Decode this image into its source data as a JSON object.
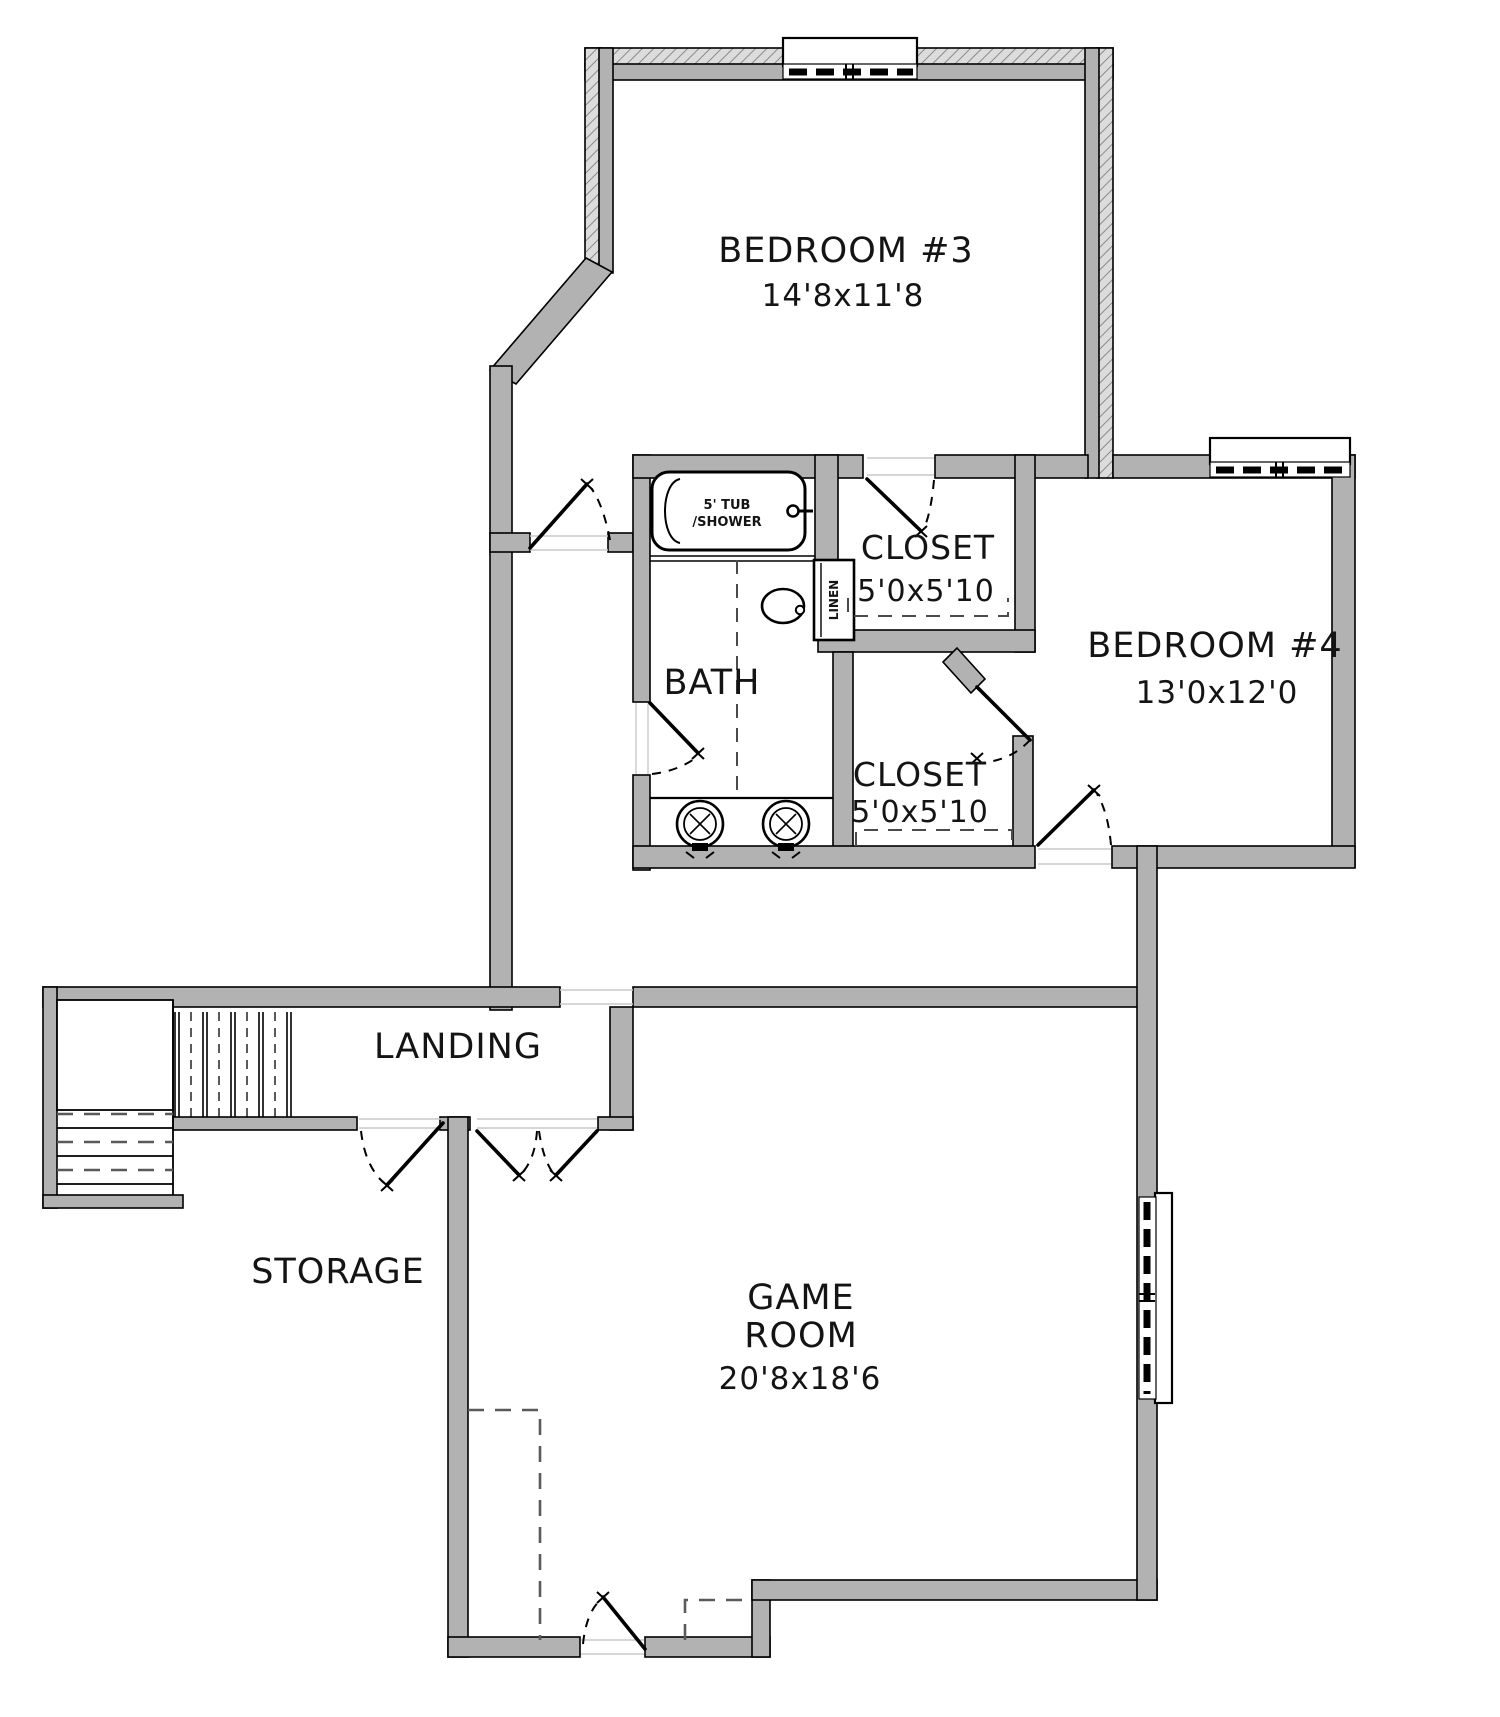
{
  "drawing": {
    "type": "floor-plan",
    "rooms": {
      "bedroom3": {
        "label": "BEDROOM #3",
        "dims": "14'8x11'8"
      },
      "bedroom4": {
        "label": "BEDROOM #4",
        "dims": "13'0x12'0"
      },
      "closet1": {
        "label": "CLOSET",
        "dims": "5'0x5'10"
      },
      "closet2": {
        "label": "CLOSET",
        "dims": "5'0x5'10"
      },
      "bath": {
        "label": "BATH"
      },
      "landing": {
        "label": "LANDING"
      },
      "storage": {
        "label": "STORAGE"
      },
      "game_room": {
        "label_line1": "GAME",
        "label_line2": "ROOM",
        "dims": "20'8x18'6"
      }
    },
    "fixtures": {
      "tub": {
        "label_line1": "5' TUB",
        "label_line2": "/SHOWER"
      },
      "linen_closet": {
        "label": "LINEN"
      }
    },
    "colors": {
      "wall_fill": "#b2b2b2",
      "hatch_bg": "#dcdcdc",
      "hatch_line": "#8a8a8a",
      "outline": "#000000"
    }
  }
}
